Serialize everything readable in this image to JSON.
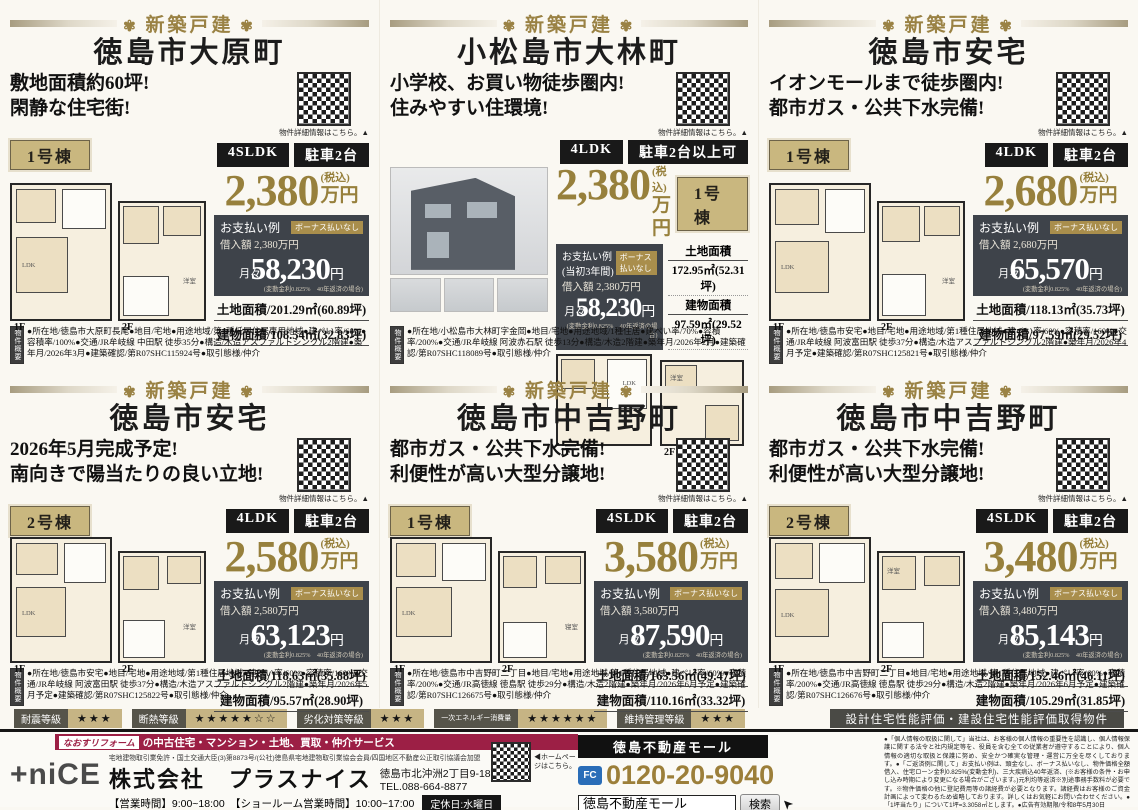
{
  "panels": [
    {
      "category": "新築戸建",
      "title": "徳島市大原町",
      "catch1": "敷地面積約60坪!",
      "catch2": "閑静な住宅街!",
      "qr_label": "物件詳細情報はこちら。▲",
      "unit": "1号棟",
      "layout": "4SLDK",
      "parking": "駐車2台",
      "price": "2,380",
      "tax": "(税込)",
      "yen": "万円",
      "pay_title": "お支払い例",
      "pay_badge": "ボーナス払いなし",
      "loan": "借入額 2,380万円",
      "monthly_label": "月々",
      "monthly": "58,230",
      "monthly_yen": "円",
      "monthly_note": "(変動金利0.825%　40年返済の場合)",
      "land": "土地面積/201.29㎡(60.89坪)",
      "building": "建物面積/108.54㎡(32.83坪)",
      "f1": "1F",
      "f2": "2F",
      "room1": "LDK",
      "room2": "洋室",
      "ov_label": "物件概要",
      "ov_text": "●所在地/徳島市大原町長尾●地目/宅地●用途地域/第1種低層住居専用地域●建ぺい率/60%●容積率/100%●交通/JR牟岐線 中田駅 徒歩35分●構造/木造アスファルトシングル2階建●築年月/2026年3月●建築確認/第R07SHC115924号●取引態様/仲介"
    },
    {
      "category": "新築戸建",
      "title": "小松島市大林町",
      "catch1": "小学校、お買い物徒歩圏内!",
      "catch2": "住みやすい住環境!",
      "qr_label": "物件詳細情報はこちら。▲",
      "unit": "1号棟",
      "layout": "4LDK",
      "parking": "駐車2台以上可",
      "price": "2,380",
      "tax": "(税込)",
      "yen": "万円",
      "pay_title": "お支払い例(当初3年間)",
      "pay_badge": "ボーナス払いなし",
      "loan": "借入額 2,380万円",
      "monthly_label": "月々",
      "monthly": "58,230",
      "monthly_yen": "円",
      "monthly_note": "(変動金利0.825%　40年返済の場合)",
      "land_label": "土地面積",
      "land_value": "172.95㎡(52.31坪)",
      "building_label": "建物面積",
      "building_value": "97.59㎡(29.52坪)",
      "f1": "1F",
      "f2": "2F",
      "room1": "LDK",
      "room2": "洋室",
      "ov_label": "物件概要",
      "ov_text": "●所在地/小松島市大林町字金岡●地目/宅地●用途地域/1種住居●建ぺい率/70%●容積率/200%●交通/JR牟岐線 阿波赤石駅 徒歩13分●構造/木造2階建●築年月/2026年2月●建築確認/第R07SHC118089号●取引態様/仲介"
    },
    {
      "category": "新築戸建",
      "title": "徳島市安宅",
      "catch1": "イオンモールまで徒歩圏内!",
      "catch2": "都市ガス・公共下水完備!",
      "qr_label": "物件詳細情報はこちら。▲",
      "unit": "1号棟",
      "layout": "4LDK",
      "parking": "駐車2台",
      "price": "2,680",
      "tax": "(税込)",
      "yen": "万円",
      "pay_title": "お支払い例",
      "pay_badge": "ボーナス払いなし",
      "loan": "借入額 2,680万円",
      "monthly_label": "月々",
      "monthly": "65,570",
      "monthly_yen": "円",
      "monthly_note": "(変動金利0.825%　40年返済の場合)",
      "land": "土地面積/118.13㎡(35.73坪)",
      "building": "建物面積/97.59㎡(29.52坪)",
      "f1": "1F",
      "f2": "2F",
      "room1": "LDK",
      "room2": "洋室",
      "ov_label": "物件概要",
      "ov_text": "●所在地/徳島市安宅●地目/宅地●用途地域/第1種住居地域●建ぺい率/60%●容積率/160%●交通/JR牟岐線 阿波富田駅 徒歩37分●構造/木造アスファルトシングル2階建●築年月/2026年4月予定●建築確認/第R07SHC125821号●取引態様/仲介"
    },
    {
      "category": "新築戸建",
      "title": "徳島市安宅",
      "catch1": "2026年5月完成予定!",
      "catch2": "南向きで陽当たりの良い立地!",
      "qr_label": "物件詳細情報はこちら。▲",
      "unit": "2号棟",
      "layout": "4LDK",
      "parking": "駐車2台",
      "price": "2,580",
      "tax": "(税込)",
      "yen": "万円",
      "pay_title": "お支払い例",
      "pay_badge": "ボーナス払いなし",
      "loan": "借入額 2,580万円",
      "monthly_label": "月々",
      "monthly": "63,123",
      "monthly_yen": "円",
      "monthly_note": "(変動金利0.825%　40年返済の場合)",
      "land": "土地面積/118.63㎡(35.88坪)",
      "building": "建物面積/95.57㎡(28.90坪)",
      "f1": "1F",
      "f2": "2F",
      "room1": "LDK",
      "room2": "洋室",
      "ov_label": "物件概要",
      "ov_text": "●所在地/徳島市安宅●地目/宅地●用途地域/第1種住居地域●建ぺい率/60%●容積率/160%●交通/JR牟岐線 阿波富田駅 徒歩37分●構造/木造アスファルトシングル2階建●築年月/2026年5月予定●建築確認/第R07SHC125822号●取引態様/仲介"
    },
    {
      "category": "新築戸建",
      "title": "徳島市中吉野町",
      "catch1": "都市ガス・公共下水完備!",
      "catch2": "利便性が高い大型分譲地!",
      "qr_label": "物件詳細情報はこちら。▲",
      "unit": "1号棟",
      "layout": "4SLDK",
      "parking": "駐車2台",
      "price": "3,580",
      "tax": "(税込)",
      "yen": "万円",
      "pay_title": "お支払い例",
      "pay_badge": "ボーナス払いなし",
      "loan": "借入額 3,580万円",
      "monthly_label": "月々",
      "monthly": "87,590",
      "monthly_yen": "円",
      "monthly_note": "(変動金利0.825%　40年返済の場合)",
      "land": "土地面積/163.56㎡(49.47坪)",
      "building": "建物面積/110.16㎡(33.32坪)",
      "f1": "1F",
      "f2": "2F",
      "room1": "LDK",
      "room2": "寝室",
      "ov_label": "物件概要",
      "ov_text": "●所在地/徳島市中吉野町二丁目●地目/宅地●用途地域/第1種住居地域●建ぺい率/60%●容積率/200%●交通/JR高徳線 徳島駅 徒歩29分●構造/木造2階建●築年月/2026年6月予定●建築確認/第R07SHC126675号●取引態様/仲介"
    },
    {
      "category": "新築戸建",
      "title": "徳島市中吉野町",
      "catch1": "都市ガス・公共下水完備!",
      "catch2": "利便性が高い大型分譲地!",
      "qr_label": "物件詳細情報はこちら。▲",
      "unit": "2号棟",
      "layout": "4SLDK",
      "parking": "駐車2台",
      "price": "3,480",
      "tax": "(税込)",
      "yen": "万円",
      "pay_title": "お支払い例",
      "pay_badge": "ボーナス払いなし",
      "loan": "借入額 3,480万円",
      "monthly_label": "月々",
      "monthly": "85,143",
      "monthly_yen": "円",
      "monthly_note": "(変動金利0.825%　40年返済の場合)",
      "land": "土地面積/152.46㎡(46.11坪)",
      "building": "建物面積/105.29㎡(31.85坪)",
      "f1": "1F",
      "f2": "2F",
      "room1": "LDK",
      "room2": "洋室",
      "ov_label": "物件概要",
      "ov_text": "●所在地/徳島市中吉野町二丁目●地目/宅地●用途地域/第1種住居地域●建ぺい率/60%●容積率/200%●交通/JR高徳線 徳島駅 徒歩29分●構造/木造2階建●築年月/2026年6月予定●建築確認/第R07SHC126676号●取引態様/仲介"
    }
  ],
  "ratings": [
    {
      "label": "耐震等級",
      "stars": "★★★"
    },
    {
      "label": "断熱等級",
      "stars": "★★★★★☆☆"
    },
    {
      "label": "劣化対策等級",
      "stars": "★★★"
    },
    {
      "label": "一次エネルギー消費量",
      "stars": "★★★★★★"
    },
    {
      "label": "維持管理等級",
      "stars": "★★★"
    }
  ],
  "ratings_cert": "設計住宅性能評価・建設住宅性能評価取得物件",
  "footer": {
    "reform_brand": "なおすリフォーム",
    "reform_tagline": "の中古住宅・マンション・土地、買取・仲介サービス",
    "logo_plus": "+niCE",
    "license": "宅地建物取引業免許・国土交通大臣(3)第8873号/(公社)徳島県宅地建物取引業協会会員/四国地区不動産公正取引協議会加盟",
    "company": "株式会社　プラスナイス",
    "address": "徳島市北沖洲2丁目9-18",
    "tel": "TEL.088-664-8877",
    "hours": "【営業時間】9:00~18:00　【ショールーム営業時間】10:00~17:00",
    "closed": "定休日:水曜日",
    "homepage_note": "◀ホームページはこちら。",
    "mall_bar": "徳島不動産モール",
    "freecall_icon_text": "FC",
    "freecall_label": "フリーコール",
    "freecall": "0120-20-9040",
    "search_value": "徳島不動産モール",
    "search_button": "検索",
    "legal": "●「個人情報の取扱に関して」当社は、お客様の個人情報の重要性を認識し、個人情報保護に関する法令と社内規定等を、役員を含む全ての従業者が遵守することにより、個人情報の適切な取扱と保護に努め、安全かつ確実な管理・運営に万全を尽くしております。●「ご返済例に関して」お支払い例は、頭金なし、ボーナス払いなし、物件価格全額借入、住宅ローン金利0.825%(変動金利)、三大疾病込40年返済、(※お客様の条件・お申し込み時期により変更になる場合がございます。)元利均等返済※別途事務手数料が必要です。※物件価格の他に登記費用等の諸経費が必要となります。諸経費はお客様のご資金計画によって変わるため省略しております。詳しくはお気軽にお問い合わせください。●「1坪当たり」について1坪=3.3058㎡とします。●広告有効期限/令和8年5月30日"
  }
}
